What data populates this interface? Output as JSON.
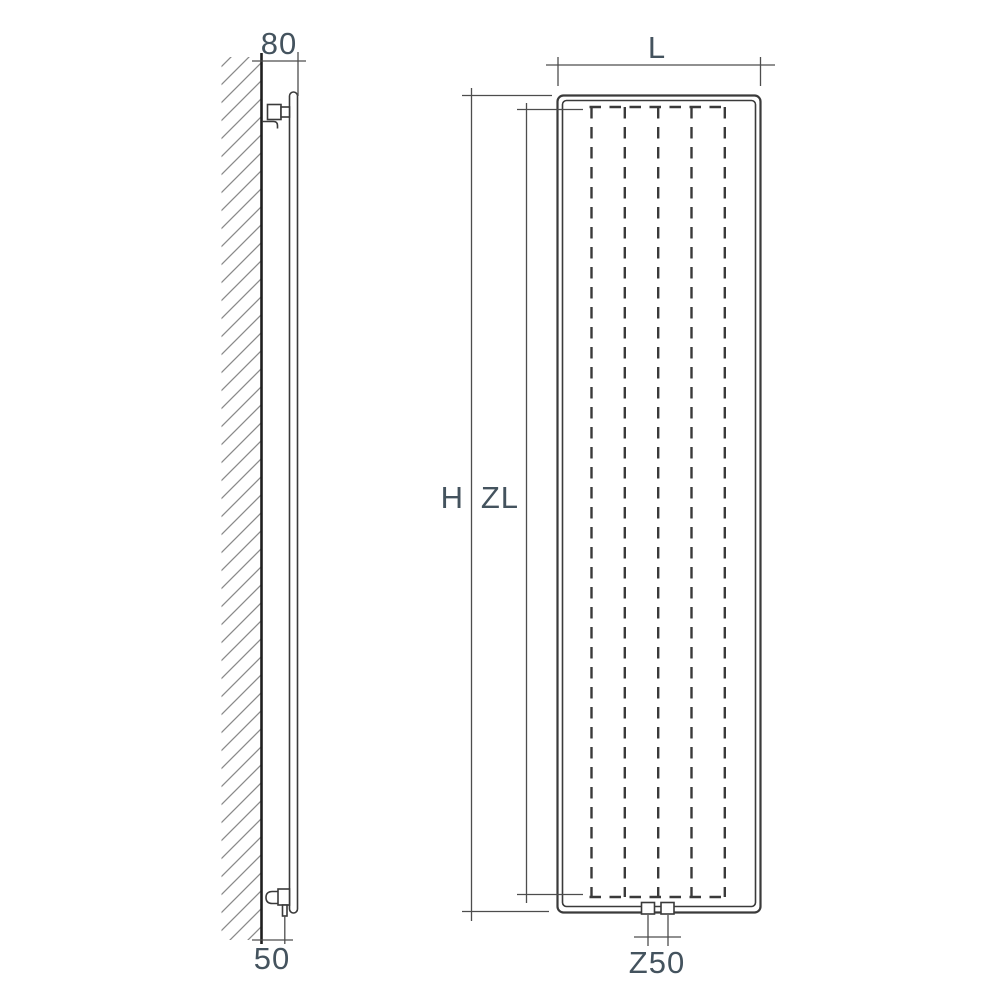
{
  "drawing": {
    "type": "technical-diagram",
    "subject": "vertical panel radiator - side elevation on wall and front elevation with dimension lines",
    "labels": {
      "depth": "80",
      "bottom_offset": "50",
      "width": "L",
      "height": "H",
      "inner_height": "ZL",
      "connection_spacing": "Z50"
    },
    "colors": {
      "line": "#3a3a3a",
      "dimension_line": "#4d4d4d",
      "wall_edge": "#1f1f1f",
      "hatch": "#8a8a8a",
      "label_text": "#44535e",
      "background": "#ffffff"
    }
  }
}
